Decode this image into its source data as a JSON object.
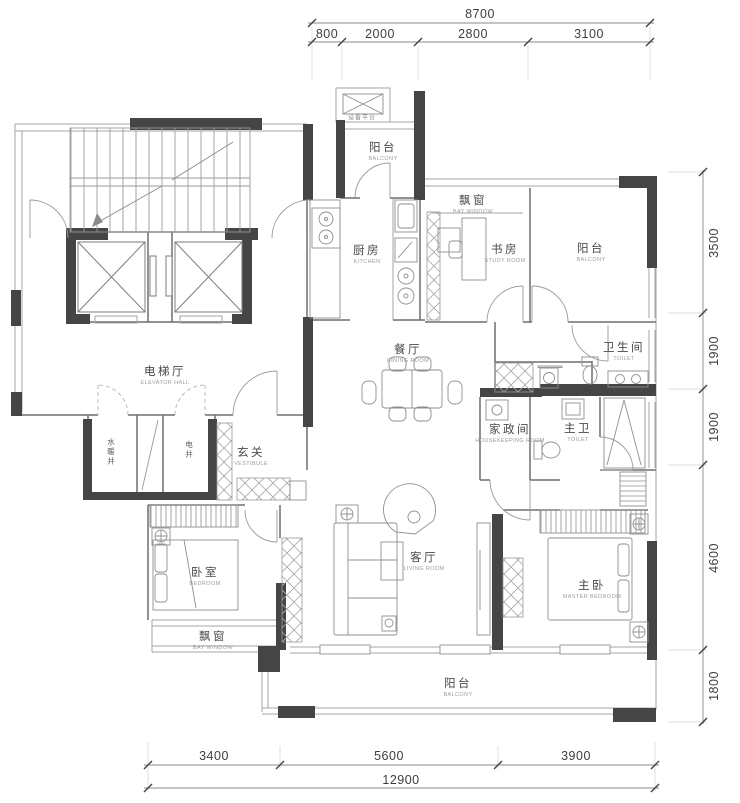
{
  "rooms": {
    "equipment_platform": {
      "zh": "设备平台"
    },
    "balcony_top": {
      "zh": "阳台",
      "en": "BALCONY"
    },
    "kitchen": {
      "zh": "厨房",
      "en": "KITCHEN"
    },
    "bay_window_study": {
      "zh": "飘窗",
      "en": "BAY WINDOW"
    },
    "study": {
      "zh": "书房",
      "en": "STUDY ROOM"
    },
    "balcony_right": {
      "zh": "阳台",
      "en": "BALCONY"
    },
    "dining": {
      "zh": "餐厅",
      "en": "DINING ROOM"
    },
    "toilet": {
      "zh": "卫生间",
      "en": "TOILET"
    },
    "elevator_hall": {
      "zh": "电梯厅",
      "en": "ELEVATOR HALL"
    },
    "water_heating_shaft": {
      "zh": "水暖井"
    },
    "electric_shaft": {
      "zh": "电井"
    },
    "vestibule": {
      "zh": "玄关",
      "en": "VESTIBULE"
    },
    "housekeeping": {
      "zh": "家政间",
      "en": "HOUSEKEEPING ROOM"
    },
    "master_toilet": {
      "zh": "主卫",
      "en": "TOILET"
    },
    "bedroom": {
      "zh": "卧室",
      "en": "BEDROOM"
    },
    "bay_window_bedroom": {
      "zh": "飘窗",
      "en": "BAY WINDOW"
    },
    "living": {
      "zh": "客厅",
      "en": "LIVING ROOM"
    },
    "master_bedroom": {
      "zh": "主卧",
      "en": "MASTER BEDROOM"
    },
    "balcony_bottom": {
      "zh": "阳台",
      "en": "BALCONY"
    }
  },
  "dimensions": {
    "top": {
      "total": "8700",
      "segments": [
        "800",
        "2000",
        "2800",
        "3100"
      ]
    },
    "right": {
      "segments": [
        "3500",
        "1900",
        "1900",
        "4600",
        "1800"
      ]
    },
    "bottom": {
      "total": "12900",
      "segments": [
        "3400",
        "5600",
        "3900"
      ]
    }
  },
  "colors": {
    "wall_dark": "#454545",
    "line_light": "#a6a6a6",
    "line_medium": "#6f6f6f",
    "text_primary": "#4a4a4a",
    "text_secondary": "#9c9c9c"
  }
}
